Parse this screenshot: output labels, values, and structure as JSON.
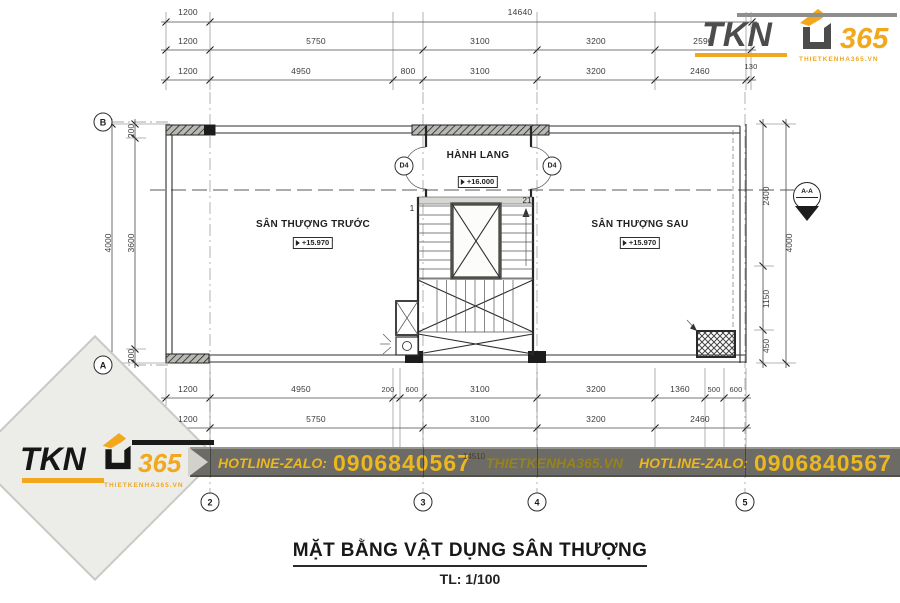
{
  "branding": {
    "logo": {
      "text": "TKN",
      "number": "365",
      "website": "THIETKENHA365.VN"
    },
    "colors": {
      "orange": "#F2A81D",
      "dark_gray": "#4C4C4C",
      "black": "#161616"
    }
  },
  "banner": {
    "hotline_label": "HOTLINE-ZALO:",
    "phone": "0906840567",
    "website": "THIETKENHA365.VN",
    "hotline_label_2": "HOTLINE-ZALO:",
    "phone_2": "0906840567"
  },
  "title_block": {
    "title": "MẶT BẰNG VẬT DỤNG SÂN THƯỢNG",
    "scale_label": "TL: 1/100"
  },
  "plan": {
    "rooms": [
      {
        "name": "SÂN THƯỢNG TRƯỚC",
        "level": "+15.970"
      },
      {
        "name": "HÀNH LANG",
        "level": "+16.000"
      },
      {
        "name": "SÂN THƯỢNG SAU",
        "level": "+15.970"
      }
    ],
    "door_label": "D4",
    "stair": {
      "first": "1",
      "last": "21"
    },
    "section_marker": {
      "label": "A-A"
    },
    "grid": {
      "rows": [
        "B",
        "A"
      ],
      "cols": [
        "2",
        "3",
        "4",
        "5"
      ]
    }
  },
  "dimensions": {
    "top_row1": [
      "1200",
      "14640"
    ],
    "top_row2": [
      "1200",
      "5750",
      "3100",
      "3200",
      "2590"
    ],
    "top_row3": [
      "1200",
      "4950",
      "800",
      "3100",
      "3200",
      "2460",
      "130"
    ],
    "bottom_row1": [
      "1200",
      "4950",
      "200",
      "600",
      "3100",
      "3200",
      "1360",
      "500",
      "600"
    ],
    "bottom_row2": [
      "1200",
      "5750",
      "3100",
      "3200",
      "2460"
    ],
    "bottom_total": "14510",
    "left_inner": [
      "200",
      "3600",
      "200"
    ],
    "left_outer": "4000",
    "right_inner": [
      "2400",
      "1150",
      "450"
    ],
    "right_outer": "4000"
  }
}
